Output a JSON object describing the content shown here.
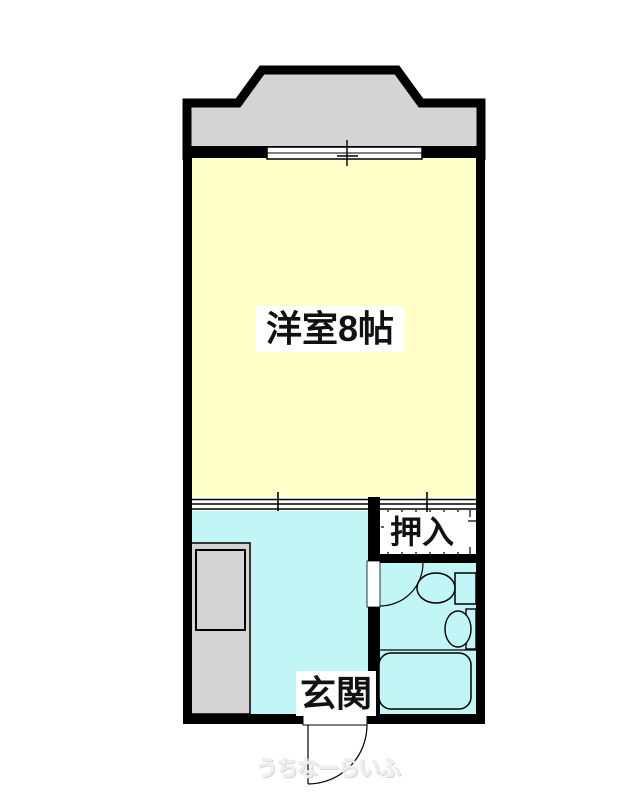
{
  "plan": {
    "main_room": {
      "label": "洋室8帖"
    },
    "closet": {
      "label": "押入"
    },
    "entrance": {
      "label": "玄関"
    },
    "watermark": {
      "text": "うちなーらいふ"
    },
    "colors": {
      "wall": "#000000",
      "main_room_fill": "#FFFFC8",
      "water_area_fill": "#C2F5F5",
      "balcony_fill": "#D4D4D4",
      "counter_fill": "#D4D4D4",
      "label_background": "#FFFFFF",
      "watermark_text": "#EFEFEF"
    }
  }
}
